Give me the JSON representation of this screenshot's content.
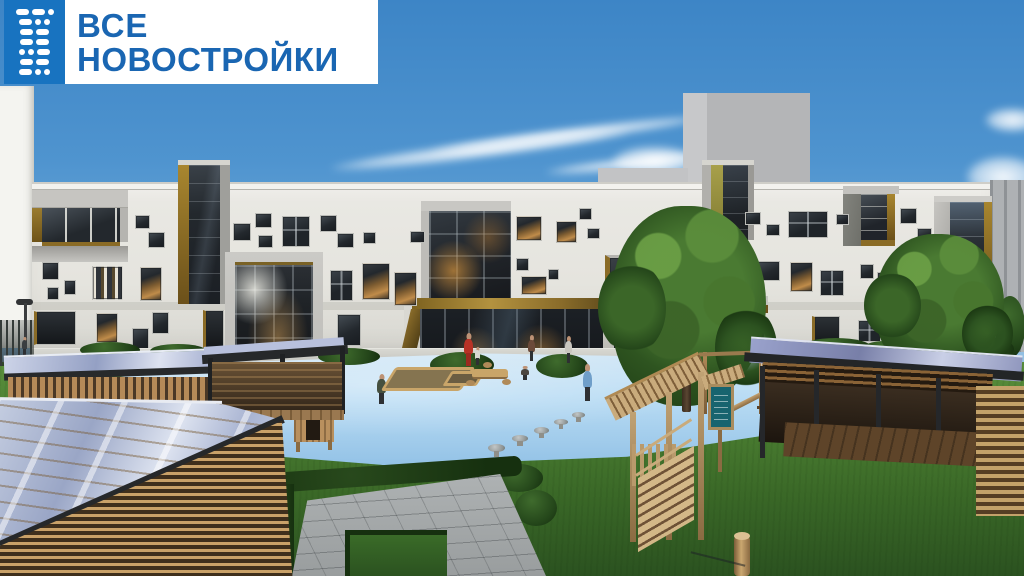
{
  "logo": {
    "line1": "ВСЕ",
    "line2": "НОВОСТРОЙКИ",
    "icon_rows": [
      [
        "d",
        "d",
        "o"
      ],
      [
        "d",
        "o",
        "o"
      ],
      [
        "d",
        "d"
      ],
      [
        "d",
        "d"
      ],
      [
        "o",
        "o",
        "d"
      ],
      [
        "d",
        "d"
      ],
      [
        "d",
        "o",
        "o"
      ]
    ],
    "icon_bg": "#1873c0",
    "text_color": "#1a66b2"
  },
  "scene": {
    "description": "3D render of a modern 3-storey white brick kindergarten building with scattered windows, gold and olive accents, a children playground with blue rubber surface, wooden play structures and wooden pavilions with glazed roofs",
    "palette": {
      "sky_top": "#3d85c6",
      "sky_horizon": "#b7d7ec",
      "facade": "#e8e7e2",
      "frame_gray": "#c6c5c1",
      "gold_accent": "#8a6b26",
      "olive_accent": "#9c9340",
      "glass_dark": "#23282d",
      "grass": "#47782e",
      "mat_blue": "#b9d9f0",
      "wood": "#b58a58",
      "hedge": "#1f3b16",
      "pavement": "#a4a8a9",
      "roof_fascia": "#26282a"
    },
    "clouds": [
      {
        "x": 330,
        "y": 142,
        "w": 300,
        "h": 16,
        "r": -7
      },
      {
        "x": 430,
        "y": 128,
        "w": 280,
        "h": 13,
        "r": -7
      },
      {
        "x": 545,
        "y": 158,
        "w": 170,
        "h": 11,
        "r": -6
      },
      {
        "x": 612,
        "y": 146,
        "w": 86,
        "h": 30,
        "r": 0
      },
      {
        "x": 985,
        "y": 108,
        "w": 55,
        "h": 24,
        "r": 0
      },
      {
        "x": 966,
        "y": 156,
        "w": 74,
        "h": 42,
        "r": 0
      },
      {
        "x": 988,
        "y": 192,
        "w": 48,
        "h": 26,
        "r": 0
      }
    ],
    "background_blocks": [
      {
        "name": "white-building-left",
        "x": 0,
        "y": 86,
        "w": 34,
        "h": 262,
        "c": "#f4f4f0"
      },
      {
        "name": "gray-tower-side",
        "x": 683,
        "y": 93,
        "w": 26,
        "h": 92,
        "c": "#c7c8ca"
      },
      {
        "name": "gray-tower-front",
        "x": 707,
        "y": 93,
        "w": 103,
        "h": 92,
        "c": "#b4b5b7"
      },
      {
        "name": "gray-parapet-mid",
        "x": 598,
        "y": 168,
        "w": 90,
        "h": 16,
        "c": "#c2c3c5"
      },
      {
        "name": "gray-building-right",
        "x": 990,
        "y": 180,
        "w": 34,
        "h": 172,
        "c": "#aeb1b4"
      }
    ],
    "windows": [
      {
        "x": 135,
        "y": 215,
        "w": 15,
        "h": 14,
        "k": "dark"
      },
      {
        "x": 148,
        "y": 232,
        "w": 17,
        "h": 16,
        "k": "dark"
      },
      {
        "x": 42,
        "y": 262,
        "w": 17,
        "h": 18,
        "k": "dark"
      },
      {
        "x": 64,
        "y": 280,
        "w": 12,
        "h": 15,
        "k": "dark"
      },
      {
        "x": 47,
        "y": 287,
        "w": 12,
        "h": 13,
        "k": "dark"
      },
      {
        "x": 92,
        "y": 266,
        "w": 31,
        "h": 34,
        "k": "striped"
      },
      {
        "x": 140,
        "y": 267,
        "w": 22,
        "h": 34,
        "k": "lit"
      },
      {
        "x": 34,
        "y": 311,
        "w": 42,
        "h": 34,
        "k": "door"
      },
      {
        "x": 96,
        "y": 313,
        "w": 22,
        "h": 30,
        "k": "lit"
      },
      {
        "x": 132,
        "y": 328,
        "w": 17,
        "h": 22,
        "k": "dark"
      },
      {
        "x": 152,
        "y": 312,
        "w": 17,
        "h": 22,
        "k": "dark"
      },
      {
        "x": 203,
        "y": 310,
        "w": 21,
        "h": 38,
        "k": "door"
      },
      {
        "x": 233,
        "y": 223,
        "w": 18,
        "h": 18,
        "k": "dark"
      },
      {
        "x": 255,
        "y": 213,
        "w": 17,
        "h": 15,
        "k": "dark"
      },
      {
        "x": 258,
        "y": 235,
        "w": 15,
        "h": 13,
        "k": "dark"
      },
      {
        "x": 282,
        "y": 216,
        "w": 28,
        "h": 31,
        "k": "grid"
      },
      {
        "x": 320,
        "y": 215,
        "w": 17,
        "h": 17,
        "k": "dark"
      },
      {
        "x": 337,
        "y": 233,
        "w": 17,
        "h": 15,
        "k": "dark"
      },
      {
        "x": 363,
        "y": 232,
        "w": 13,
        "h": 12,
        "k": "dark"
      },
      {
        "x": 330,
        "y": 270,
        "w": 23,
        "h": 31,
        "k": "grid"
      },
      {
        "x": 362,
        "y": 263,
        "w": 28,
        "h": 37,
        "k": "lit"
      },
      {
        "x": 394,
        "y": 272,
        "w": 23,
        "h": 34,
        "k": "lit"
      },
      {
        "x": 410,
        "y": 231,
        "w": 15,
        "h": 12,
        "k": "dark"
      },
      {
        "x": 337,
        "y": 314,
        "w": 24,
        "h": 32,
        "k": "dark"
      },
      {
        "x": 516,
        "y": 216,
        "w": 26,
        "h": 25,
        "k": "lit"
      },
      {
        "x": 556,
        "y": 221,
        "w": 21,
        "h": 22,
        "k": "lit"
      },
      {
        "x": 579,
        "y": 208,
        "w": 13,
        "h": 12,
        "k": "dark"
      },
      {
        "x": 587,
        "y": 228,
        "w": 13,
        "h": 11,
        "k": "dark"
      },
      {
        "x": 516,
        "y": 258,
        "w": 13,
        "h": 13,
        "k": "dark"
      },
      {
        "x": 521,
        "y": 276,
        "w": 26,
        "h": 19,
        "k": "lit"
      },
      {
        "x": 548,
        "y": 269,
        "w": 11,
        "h": 11,
        "k": "dark"
      },
      {
        "x": 605,
        "y": 255,
        "w": 43,
        "h": 47,
        "k": "baywin"
      },
      {
        "x": 613,
        "y": 320,
        "w": 36,
        "h": 38,
        "k": "grid"
      },
      {
        "x": 656,
        "y": 320,
        "w": 17,
        "h": 20,
        "k": "dark"
      },
      {
        "x": 655,
        "y": 216,
        "w": 16,
        "h": 13,
        "k": "dark"
      },
      {
        "x": 745,
        "y": 212,
        "w": 16,
        "h": 13,
        "k": "dark"
      },
      {
        "x": 766,
        "y": 224,
        "w": 14,
        "h": 12,
        "k": "dark"
      },
      {
        "x": 788,
        "y": 211,
        "w": 40,
        "h": 27,
        "k": "grid"
      },
      {
        "x": 836,
        "y": 214,
        "w": 13,
        "h": 11,
        "k": "dark"
      },
      {
        "x": 756,
        "y": 261,
        "w": 24,
        "h": 20,
        "k": "dark"
      },
      {
        "x": 790,
        "y": 262,
        "w": 23,
        "h": 30,
        "k": "lit"
      },
      {
        "x": 820,
        "y": 270,
        "w": 24,
        "h": 26,
        "k": "grid"
      },
      {
        "x": 860,
        "y": 264,
        "w": 14,
        "h": 15,
        "k": "dark"
      },
      {
        "x": 877,
        "y": 272,
        "w": 15,
        "h": 16,
        "k": "dark"
      },
      {
        "x": 812,
        "y": 316,
        "w": 28,
        "h": 30,
        "k": "door"
      },
      {
        "x": 858,
        "y": 320,
        "w": 23,
        "h": 22,
        "k": "grid"
      },
      {
        "x": 900,
        "y": 208,
        "w": 17,
        "h": 16,
        "k": "dark"
      },
      {
        "x": 917,
        "y": 228,
        "w": 15,
        "h": 14,
        "k": "dark"
      }
    ],
    "bushes": [
      {
        "x": 80,
        "y": 342,
        "w": 60,
        "h": 16
      },
      {
        "x": 150,
        "y": 344,
        "w": 56,
        "h": 14
      },
      {
        "x": 250,
        "y": 346,
        "w": 44,
        "h": 13
      },
      {
        "x": 318,
        "y": 348,
        "w": 62,
        "h": 17
      },
      {
        "x": 430,
        "y": 352,
        "w": 64,
        "h": 26
      },
      {
        "x": 536,
        "y": 354,
        "w": 52,
        "h": 24
      },
      {
        "x": 630,
        "y": 347,
        "w": 44,
        "h": 16
      },
      {
        "x": 688,
        "y": 349,
        "w": 40,
        "h": 14
      },
      {
        "x": 800,
        "y": 338,
        "w": 72,
        "h": 20
      },
      {
        "x": 862,
        "y": 341,
        "w": 46,
        "h": 16
      },
      {
        "x": 995,
        "y": 296,
        "w": 30,
        "h": 62
      },
      {
        "x": 952,
        "y": 336,
        "w": 62,
        "h": 26
      },
      {
        "x": 495,
        "y": 464,
        "w": 48,
        "h": 28
      },
      {
        "x": 515,
        "y": 490,
        "w": 42,
        "h": 36
      }
    ],
    "people": [
      {
        "x": 463,
        "y": 333,
        "w": 11,
        "h": 33,
        "c": "#b83226",
        "lc": "#9c2a20",
        "name": "woman-red-dress"
      },
      {
        "x": 474,
        "y": 347,
        "w": 7,
        "h": 18,
        "c": "#d8d8d2",
        "name": "child-walkway"
      },
      {
        "x": 527,
        "y": 335,
        "w": 9,
        "h": 26,
        "c": "#6b4a3a",
        "name": "person-entrance"
      },
      {
        "x": 564,
        "y": 336,
        "w": 9,
        "h": 27,
        "c": "#c9c6bf",
        "name": "person-entrance"
      },
      {
        "x": 581,
        "y": 364,
        "w": 13,
        "h": 37,
        "c": "#6f9ec9",
        "name": "child-playground"
      },
      {
        "x": 376,
        "y": 374,
        "w": 11,
        "h": 30,
        "c": "#45503f",
        "name": "child-playground"
      },
      {
        "x": 520,
        "y": 366,
        "w": 10,
        "h": 14,
        "c": "#4a4540",
        "name": "child-playground"
      },
      {
        "x": 21,
        "y": 337,
        "w": 7,
        "h": 19,
        "c": "#3a3e41",
        "name": "pedestrian"
      }
    ],
    "stools": [
      {
        "x": 488,
        "y": 444,
        "w": 17,
        "h": 8
      },
      {
        "x": 512,
        "y": 435,
        "w": 16,
        "h": 7
      },
      {
        "x": 534,
        "y": 427,
        "w": 15,
        "h": 7
      },
      {
        "x": 554,
        "y": 419,
        "w": 14,
        "h": 6
      },
      {
        "x": 572,
        "y": 412,
        "w": 13,
        "h": 6
      },
      {
        "x": 30,
        "y": 424,
        "w": 14,
        "h": 7
      },
      {
        "x": 52,
        "y": 416,
        "w": 13,
        "h": 6
      }
    ]
  }
}
